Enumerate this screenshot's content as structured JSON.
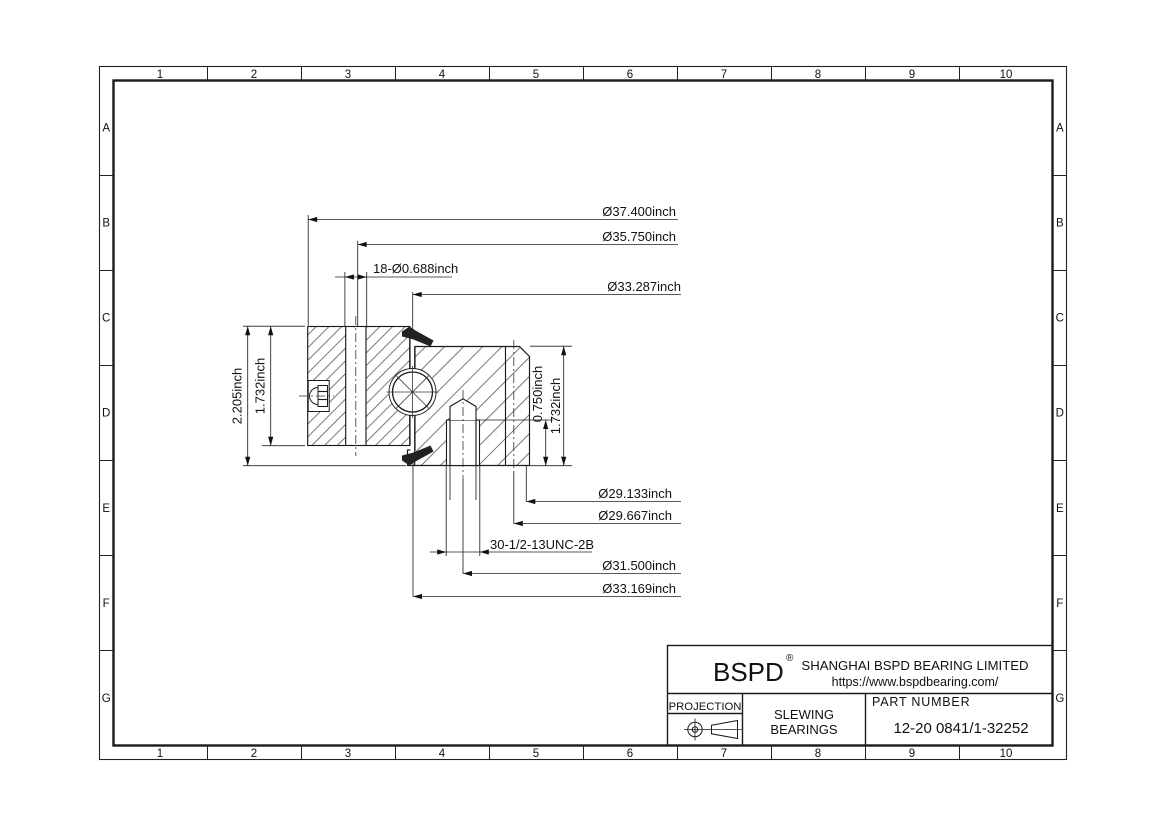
{
  "sheet": {
    "background": "#ffffff",
    "line_color": "#1a1a1a"
  },
  "border": {
    "columns": [
      "1",
      "2",
      "3",
      "4",
      "5",
      "6",
      "7",
      "8",
      "9",
      "10"
    ],
    "rows": [
      "A",
      "B",
      "C",
      "D",
      "E",
      "F",
      "G"
    ]
  },
  "dimensions": {
    "outer_diameter": "Ø37.400inch",
    "outer_step_diameter": "Ø35.750inch",
    "mounting_holes": "18-Ø0.688inch",
    "raceway_upper_diameter": "Ø33.287inch",
    "bore_diameter": "Ø29.133inch",
    "inner_step_diameter": "Ø29.667inch",
    "tapped_holes": "30-1/2-13UNC-2B",
    "tapped_hole_circle_diameter": "Ø31.500inch",
    "raceway_lower_diameter": "Ø33.169inch",
    "total_height": "2.205inch",
    "outer_ring_height": "1.732inch",
    "thread_depth": "0.750inch",
    "inner_ring_height": "1.732inch"
  },
  "title_block": {
    "logo": "BSPD",
    "registered_mark": "®",
    "company": "SHANGHAI BSPD BEARING LIMITED",
    "website": "https://www.bspdbearing.com/",
    "projection_label": "PROJECTION",
    "product_line1": "SLEWING",
    "product_line2": "BEARINGS",
    "part_number_label": "PART  NUMBER",
    "part_number": "12-20 0841/1-32252"
  }
}
